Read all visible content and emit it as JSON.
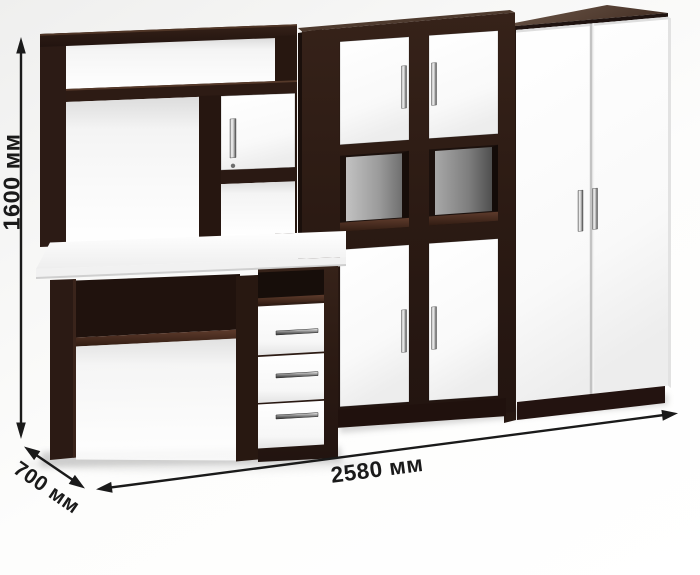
{
  "dimensions": {
    "height": {
      "label": "1600 мм"
    },
    "width": {
      "label": "2580 мм"
    },
    "depth": {
      "label": "700 мм"
    }
  },
  "colors": {
    "body_dark_wenge": "#2e1c15",
    "front_white": "#ffffff",
    "handle_chrome": "#c9c9c9",
    "cubby_back_gray": "#9a9a9a",
    "annotation_black": "#1a1a1a",
    "background": "#f7f7f6"
  }
}
